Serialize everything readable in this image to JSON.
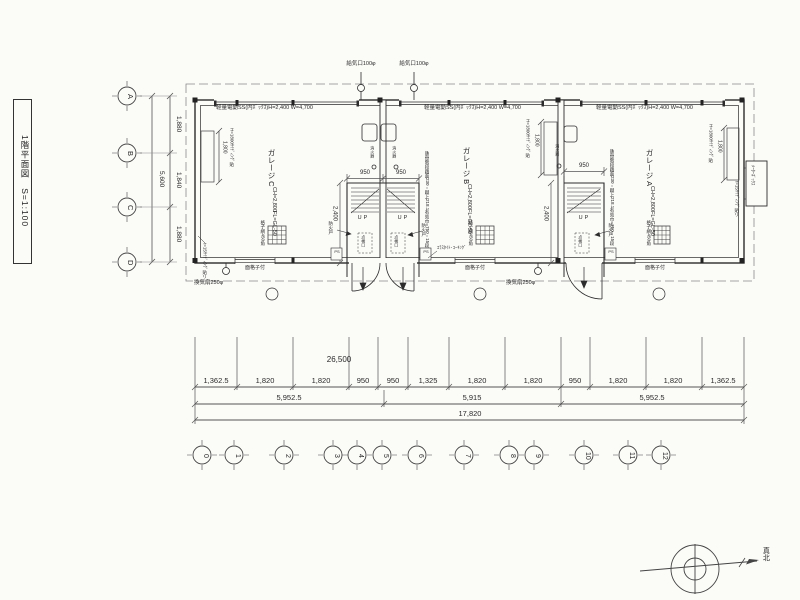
{
  "title_block": {
    "label": "1階平面図　S=1:100"
  },
  "grid": {
    "row_labels": [
      "A",
      "B",
      "C",
      "D"
    ],
    "col_labels": [
      "0",
      "1",
      "2",
      "3",
      "4",
      "5",
      "6",
      "7",
      "8",
      "9",
      "10",
      "11",
      "12"
    ]
  },
  "dimensions": {
    "left": {
      "segments": [
        "1,880",
        "1,840",
        "1,880"
      ],
      "total": "5,600"
    },
    "bottom": {
      "row1": [
        "1,362.5",
        "1,820",
        "1,820",
        "950",
        "950",
        "1,325",
        "1,820",
        "1,820",
        "950",
        "1,820",
        "1,820",
        "1,362.5"
      ],
      "row2": [
        "5,952.5",
        "5,915",
        "5,952.5"
      ],
      "total": "17,820",
      "site_width": "26,500"
    },
    "stair_width": "950",
    "stair_depth": "2,400",
    "siding_height": "1,800"
  },
  "annotations": {
    "shutter": "軽量電動SS(内ﾎﾞｯｸｽ)H=2,400 W=4,700",
    "supply_port": "給気口100φ",
    "exhaust_fan": "換気扇250φ",
    "window_grille": "面格子付",
    "caulking": "ｴﾗｽﾀｲﾄ･ｺｰｷﾝｸﾞ",
    "siding_note": "H=1800ｻｲﾃﾞｨﾝｸﾞ貼",
    "ext_siding": "t=15ｻｲﾃﾞｨﾝｸﾞ貼リ",
    "grating": "格子網450角",
    "meter_box": "ﾒｰﾀｰﾎﾞｯｸｽ",
    "extinguisher": "消火器",
    "ps": "PS"
  },
  "stair": {
    "name": "鉄骨階段",
    "tread": "踏面230・蹴上218.1",
    "width_note": "有効巾=750・15段",
    "up": "UP",
    "inspection": "点検口",
    "fire_door": "防火戸"
  },
  "garages": [
    {
      "name": "ガレージ C",
      "ch": "CH=2,800",
      "fl": "FL=GL-50"
    },
    {
      "name": "ガレージ B",
      "ch": "CH=2,800",
      "fl": "FL=GL-50"
    },
    {
      "name": "ガレージ A",
      "ch": "CH=2,800",
      "fl": "FL=GL-50"
    }
  ],
  "compass": {
    "north": "真北"
  }
}
